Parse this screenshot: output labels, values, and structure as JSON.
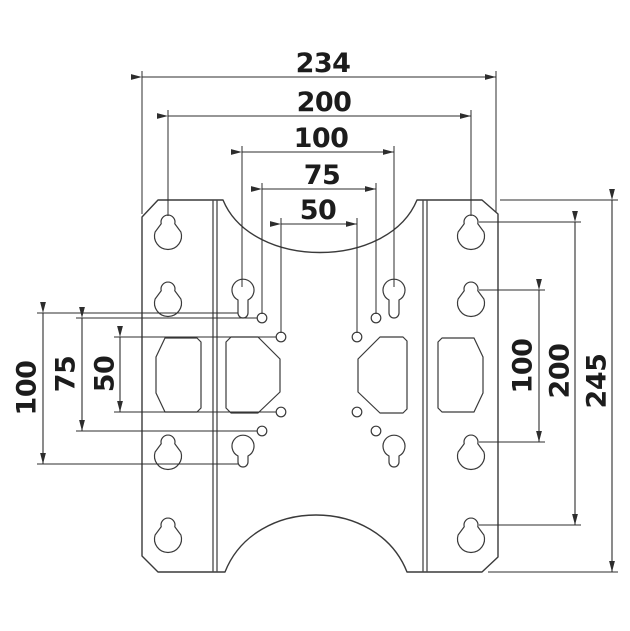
{
  "colors": {
    "background": "#ffffff",
    "line": "#3a3a3a",
    "dimension_line": "#2d2d2d",
    "text": "#1c1c1c"
  },
  "drawing": {
    "type": "technical-dimension-drawing",
    "subject": "vesa-mount-adapter-plate"
  },
  "dimensions": {
    "horizontal_top": [
      {
        "id": "overall-width",
        "value": "234"
      },
      {
        "id": "rail-keyhole-spacing",
        "value": "200"
      },
      {
        "id": "vesa-width-100",
        "value": "100"
      },
      {
        "id": "vesa-width-75",
        "value": "75"
      },
      {
        "id": "vesa-width-50",
        "value": "50"
      }
    ],
    "vertical_left": [
      {
        "id": "vesa-height-100",
        "value": "100"
      },
      {
        "id": "vesa-height-75",
        "value": "75"
      },
      {
        "id": "vesa-height-50",
        "value": "50"
      }
    ],
    "vertical_right": [
      {
        "id": "rail-hole-spacing-100",
        "value": "100"
      },
      {
        "id": "rail-hole-spacing-200",
        "value": "200"
      },
      {
        "id": "overall-height",
        "value": "245"
      }
    ]
  }
}
